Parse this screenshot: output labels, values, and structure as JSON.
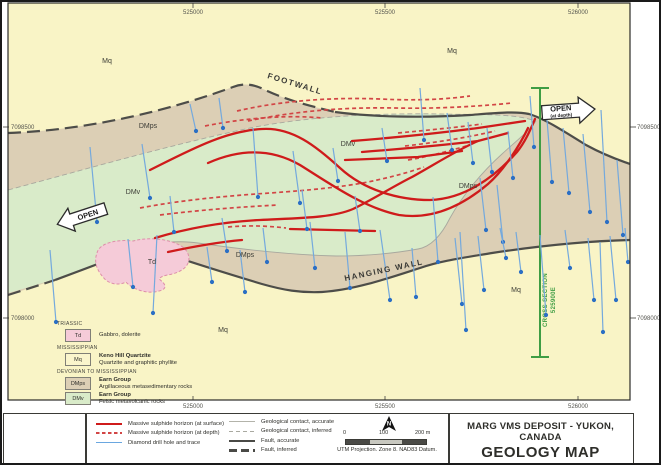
{
  "colors": {
    "mq_fill": "#f9f4c6",
    "dmps_fill": "#dccfb5",
    "dmv_fill": "#d9ebc9",
    "td_fill": "#f5cbd8",
    "sulphide_surface": "#cf1b1b",
    "sulphide_depth": "#d24545",
    "drill_trace": "#74a9dd",
    "drill_dot": "#2b6fc4",
    "fault": "#4d4d49",
    "contact": "#a8a89e",
    "cross_section": "#3f9d44"
  },
  "map": {
    "units_fill": {
      "Mq": "#f9f4c6",
      "DMps": "#dccfb5",
      "DMv": "#d9ebc9",
      "Td": "#f5cbd8"
    },
    "paths": {
      "dmps_band": "M8,133 C90,130 170,110 233,87 C243,83 253,84 263,89 C286,100 310,106 335,112 C372,117 422,118 470,115 C496,113 516,111 529,114 C543,118 562,130 586,145 C608,157 622,161 630,164 L630,240 C590,241 545,245 492,253 C462,258 440,261 420,268 C392,277 355,290 322,292 C300,293 283,290 262,284 C222,272 172,256 143,246 C118,257 60,279 8,295 Z",
      "dmv_lens": "M8,190 C90,168 170,145 250,128 C310,116 380,113 440,114 C480,115 512,113 536,121 C528,132 515,142 502,154 C482,172 462,196 450,218 C441,236 430,247 418,249 C396,253 368,256 336,256 C296,255 246,250 198,243 C175,240 155,241 143,246 C118,257 60,279 8,293 Z",
      "td_stock": "M97,253 C99,244 114,239 133,241 C152,236 174,240 184,248 C192,256 190,266 180,271 C171,276 163,274 159,279 C166,284 168,289 159,291 C146,295 131,288 126,282 C118,286 108,284 103,277 C96,269 94,261 97,253 Z",
      "contact_upper": "M8,190 C90,168 170,145 250,128 C310,116 380,113 440,114 C480,115 512,113 536,121",
      "contact_lower": "M143,246 C165,241 185,241 198,243 C246,250 296,255 336,256 C368,256 396,253 418,249 C430,247 441,236 450,218 C462,196 482,172 502,154 C515,142 528,132 536,121",
      "fault_footwall_inferred": "M8,133 C90,130 170,110 233,87 C243,83 253,84 263,89 C286,100 310,106 335,112",
      "fault_footwall_accurate": "M335,112 C372,117 422,118 470,115 C496,113 516,111 529,114 C543,118 562,130 586,145 C608,157 622,161 630,164",
      "fault_hangingwall_inferred": "M8,295 C24,290 40,285 55,280",
      "fault_hangingwall_accurate": "M55,280 C90,267 120,256 143,246 C172,256 222,272 262,284 C283,290 300,293 322,292 C355,290 392,277 420,268 C440,261 462,258 492,253 C545,245 590,241 630,240"
    },
    "sulphide_surface": [
      "M150,170 C190,150 225,131 262,129 C292,127 316,146 340,168 C364,190 398,200 430,200 C464,199 494,178 517,152 C526,141 531,128 535,119",
      "M208,163 C244,147 274,150 300,165 C329,183 364,208 399,215 C432,220 462,206 488,184 C504,170 520,145 528,128",
      "M352,141 C390,138 440,133 478,128 L525,121",
      "M362,152 C400,149 445,145 478,141 L508,133",
      "M345,160 L418,157 L462,151",
      "M155,238 C185,229 220,222 260,220 C300,218 332,218 353,209 C372,200 392,187 412,177 C432,166 457,150 478,141",
      "M290,229 L375,231",
      "M168,252 C196,246 220,242 242,240"
    ],
    "sulphide_depth": [
      "M237,111 C280,101 330,97 380,99 C420,101 448,99 470,96",
      "M248,121 C295,111 345,107 395,108 C440,109 482,106 512,103",
      "M205,126 C250,117 292,115 322,118",
      "M398,133 C430,130 460,127 482,124",
      "M405,146 C440,142 470,137 495,131",
      "M140,208 C182,200 226,196 270,193 C312,190 342,187 368,182 C392,177 410,172 424,167",
      "M160,215 C200,210 240,207 278,205",
      "M228,227 C250,225 268,226 286,228",
      "M408,160 C432,156 452,150 470,145"
    ],
    "drill_holes": [
      [
        90,
        147,
        97,
        222
      ],
      [
        142,
        144,
        150,
        198
      ],
      [
        170,
        196,
        174,
        232
      ],
      [
        219,
        98,
        223,
        128
      ],
      [
        190,
        104,
        196,
        131
      ],
      [
        253,
        128,
        258,
        197
      ],
      [
        293,
        151,
        300,
        203
      ],
      [
        302,
        190,
        307,
        229
      ],
      [
        333,
        148,
        338,
        181
      ],
      [
        355,
        196,
        360,
        231
      ],
      [
        382,
        128,
        387,
        161
      ],
      [
        222,
        218,
        227,
        251
      ],
      [
        263,
        228,
        267,
        262
      ],
      [
        128,
        239,
        133,
        287
      ],
      [
        50,
        250,
        56,
        322
      ],
      [
        157,
        235,
        153,
        313
      ],
      [
        310,
        222,
        315,
        268
      ],
      [
        207,
        247,
        212,
        282
      ],
      [
        240,
        250,
        245,
        292
      ],
      [
        345,
        232,
        350,
        288
      ],
      [
        380,
        230,
        390,
        300
      ],
      [
        412,
        248,
        416,
        297
      ],
      [
        433,
        197,
        438,
        262
      ],
      [
        420,
        88,
        424,
        140
      ],
      [
        447,
        113,
        452,
        150
      ],
      [
        468,
        122,
        473,
        163
      ],
      [
        487,
        128,
        492,
        172
      ],
      [
        508,
        131,
        513,
        178
      ],
      [
        530,
        96,
        534,
        147
      ],
      [
        547,
        120,
        552,
        182
      ],
      [
        563,
        128,
        569,
        193
      ],
      [
        583,
        134,
        590,
        212
      ],
      [
        601,
        110,
        607,
        222
      ],
      [
        617,
        160,
        623,
        235
      ],
      [
        480,
        178,
        486,
        230
      ],
      [
        497,
        185,
        503,
        242
      ],
      [
        455,
        238,
        462,
        304
      ],
      [
        478,
        236,
        484,
        290
      ],
      [
        500,
        228,
        506,
        258
      ],
      [
        516,
        232,
        521,
        272
      ],
      [
        540,
        235,
        546,
        315
      ],
      [
        565,
        230,
        570,
        268
      ],
      [
        588,
        238,
        594,
        300
      ],
      [
        610,
        236,
        616,
        300
      ],
      [
        460,
        232,
        466,
        330
      ],
      [
        625,
        228,
        628,
        262
      ],
      [
        600,
        242,
        603,
        332
      ]
    ],
    "cross_section": {
      "x": 540,
      "y1": 88,
      "y2": 357,
      "label1": "CROSS-SECTION",
      "label2": "525900E"
    },
    "region_labels": [
      {
        "t": "Mq",
        "x": 107,
        "y": 63
      },
      {
        "t": "Mq",
        "x": 452,
        "y": 53
      },
      {
        "t": "Mq",
        "x": 223,
        "y": 332
      },
      {
        "t": "Mq",
        "x": 516,
        "y": 292
      },
      {
        "t": "DMps",
        "x": 148,
        "y": 128
      },
      {
        "t": "DMps",
        "x": 245,
        "y": 257
      },
      {
        "t": "DMps",
        "x": 468,
        "y": 188
      },
      {
        "t": "DMv",
        "x": 133,
        "y": 194
      },
      {
        "t": "DMv",
        "x": 348,
        "y": 146
      },
      {
        "t": "Td",
        "x": 152,
        "y": 264
      }
    ],
    "wall_labels": [
      {
        "t": "FOOTWALL",
        "x": 267,
        "y": 78,
        "r": 17
      },
      {
        "t": "HANGING WALL",
        "x": 345,
        "y": 281,
        "r": -12
      }
    ],
    "open_west": {
      "label": "OPEN",
      "x": 83,
      "y": 216,
      "rotate": -18
    },
    "open_east": {
      "label": "OPEN",
      "sub": "(at depth)",
      "x": 567,
      "y": 111,
      "rotate": -4
    },
    "grid": {
      "top": [
        {
          "label": "525000",
          "x": 193
        },
        {
          "label": "525500",
          "x": 385
        },
        {
          "label": "526000",
          "x": 578
        }
      ],
      "bottom": [
        {
          "label": "525000",
          "x": 193
        },
        {
          "label": "525500",
          "x": 385
        },
        {
          "label": "526000",
          "x": 578
        }
      ],
      "left": [
        {
          "label": "7098500",
          "y": 127
        },
        {
          "label": "7098000",
          "y": 318
        }
      ],
      "right": [
        {
          "label": "7098500",
          "y": 127
        },
        {
          "label": "7098000",
          "y": 318
        }
      ]
    }
  },
  "stratigraphy_legend": {
    "groups": [
      {
        "era": "TRIASSIC",
        "units": [
          {
            "code": "Td",
            "name": "",
            "desc": "Gabbro, dolerite"
          }
        ]
      },
      {
        "era": "MISSISSIPPIAN",
        "units": [
          {
            "code": "Mq",
            "name": "Keno Hill Quartzite",
            "desc": "Quartzite and graphitic phyllite"
          }
        ]
      },
      {
        "era": "DEVONIAN TO MISSISSIPPIAN",
        "units": [
          {
            "code": "DMps",
            "name": "Earn Group",
            "desc": "Argillaceous metasedimentary rocks"
          },
          {
            "code": "DMv",
            "name": "Earn Group",
            "desc": "Felsic metavolcanic rocks"
          }
        ]
      }
    ]
  },
  "symbol_legend": {
    "left": [
      {
        "label": "Massive sulphide horizon (at surface)",
        "symbol": "red-solid"
      },
      {
        "label": "Massive sulphide horizon (at depth)",
        "symbol": "red-dashed"
      },
      {
        "label": "Diamond drill hole and trace",
        "symbol": "blue-line"
      }
    ],
    "right": [
      {
        "label": "Geological contact, accurate",
        "symbol": "gray-line"
      },
      {
        "label": "Geological contact, inferred",
        "symbol": "gray-dashed"
      },
      {
        "label": "Fault, accurate",
        "symbol": "dark-line"
      },
      {
        "label": "Fault, inferred",
        "symbol": "dark-dashed"
      }
    ]
  },
  "scale": {
    "ticks": [
      "0",
      "100",
      "200 m"
    ],
    "projection": "UTM Projection. Zone 8. NAD83 Datum.",
    "north": "N"
  },
  "title_block": {
    "line1": "MARG VMS DEPOSIT - YUKON, CANADA",
    "line2": "GEOLOGY MAP"
  }
}
